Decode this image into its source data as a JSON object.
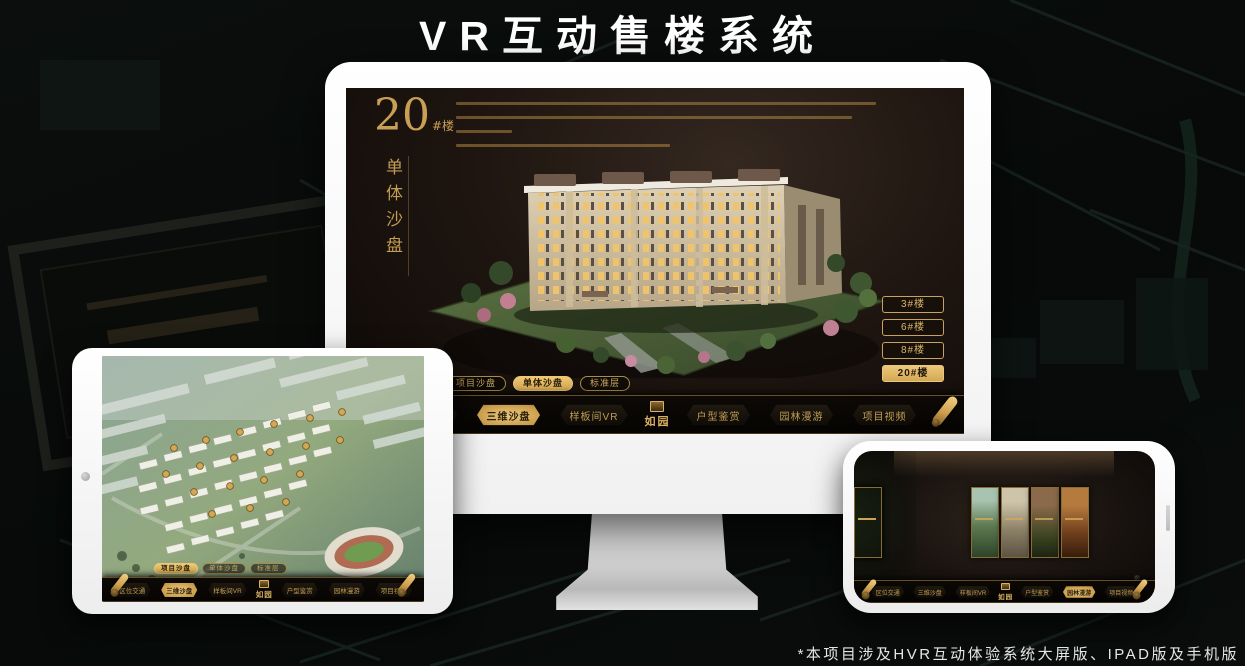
{
  "page": {
    "title": "VR互动售楼系统",
    "footnote": "*本项目涉及HVR互动体验系统大屏版、IPAD版及手机版"
  },
  "brand": {
    "logo_text": "如园",
    "gold_color": "#d2a855",
    "screen_bg_color": "#1e1510"
  },
  "monitor": {
    "hero": {
      "number": "20",
      "suffix": "#楼",
      "subtitle": "单体沙盘"
    },
    "floor_buttons": [
      {
        "label": "3#楼",
        "active": false
      },
      {
        "label": "6#楼",
        "active": false
      },
      {
        "label": "8#楼",
        "active": false
      },
      {
        "label": "20#楼",
        "active": true
      }
    ],
    "view_tabs": [
      {
        "label": "项目沙盘",
        "active": false
      },
      {
        "label": "单体沙盘",
        "active": true
      },
      {
        "label": "标准层",
        "active": false
      }
    ],
    "nav_left": [
      {
        "label": "区位交通",
        "active": false
      },
      {
        "label": "三维沙盘",
        "active": true
      },
      {
        "label": "样板间VR",
        "active": false
      }
    ],
    "nav_right": [
      {
        "label": "户型鉴赏",
        "active": false
      },
      {
        "label": "园林漫游",
        "active": false
      },
      {
        "label": "项目视频",
        "active": false
      }
    ]
  },
  "tablet": {
    "view_tabs": [
      {
        "label": "项目沙盘",
        "active": true
      },
      {
        "label": "单体沙盘",
        "active": false
      },
      {
        "label": "标准层",
        "active": false
      }
    ],
    "nav_left": [
      {
        "label": "区位交通",
        "active": false
      },
      {
        "label": "三维沙盘",
        "active": true
      },
      {
        "label": "样板间VR",
        "active": false
      }
    ],
    "nav_right": [
      {
        "label": "户型鉴赏",
        "active": false
      },
      {
        "label": "园林漫游",
        "active": false
      },
      {
        "label": "项目视频",
        "active": false
      }
    ]
  },
  "phone": {
    "gallery_card_count": 6,
    "nav_left": [
      {
        "label": "区位交通",
        "active": false
      },
      {
        "label": "三维沙盘",
        "active": false
      },
      {
        "label": "样板间VR",
        "active": false
      }
    ],
    "nav_right": [
      {
        "label": "户型鉴赏",
        "active": false
      },
      {
        "label": "园林漫游",
        "active": true
      },
      {
        "label": "项目视频",
        "active": false
      }
    ]
  }
}
